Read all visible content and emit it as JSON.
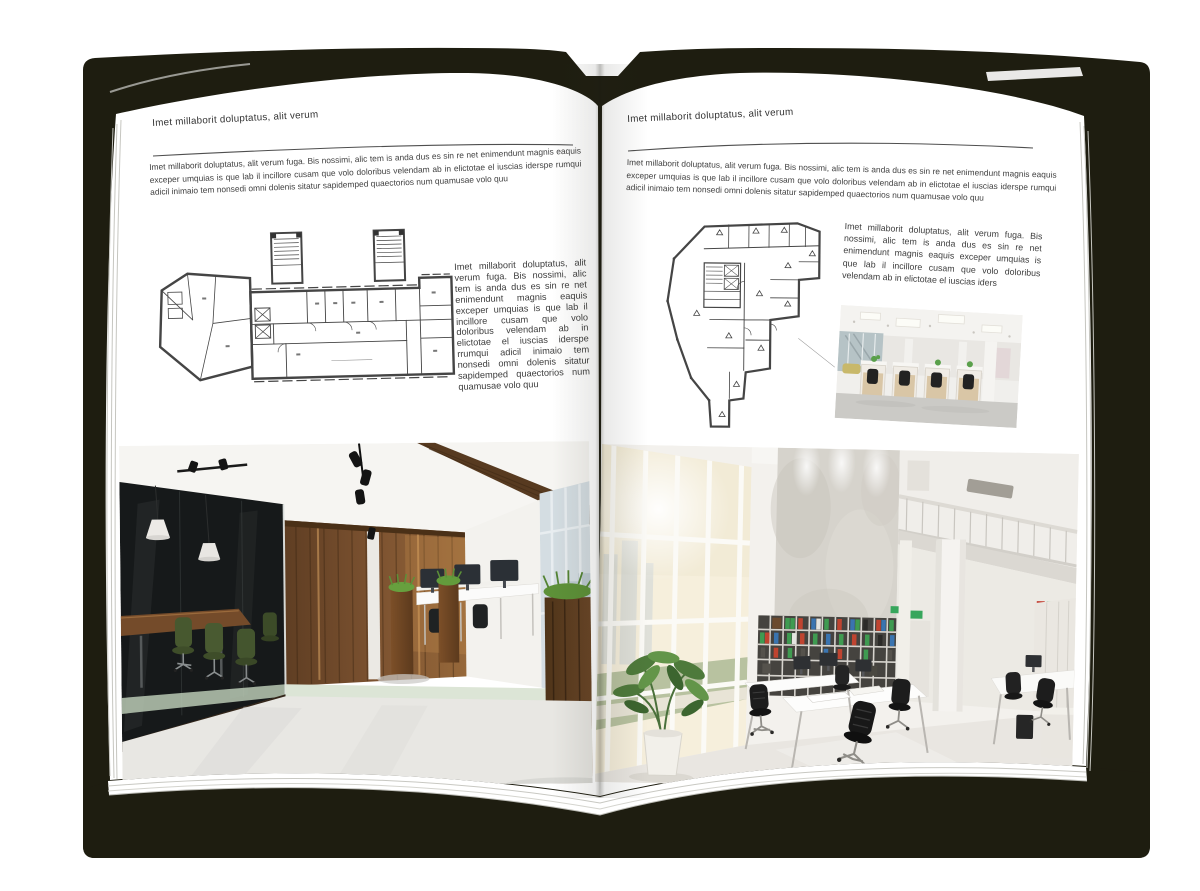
{
  "book": {
    "cover_color": "#1e1d10",
    "page_color": "#ffffff"
  },
  "left_page": {
    "header": "Imet millaborit doluptatus, alit verum",
    "intro": "Imet millaborit doluptatus, alit verum fuga. Bis nossimi, alic tem is anda dus es sin re net enimendunt magnis eaquis exceper umquias is que lab il incillore cusam que volo doloribus velendam ab in elictotae el iuscias iderspe rumqui adicil inimaio tem nonsedi omni dolenis sitatur sapidemped quaectorios num quamusae volo quu",
    "side_text": "Imet millaborit doluptatus, alit verum fuga. Bis nossimi, alic tem is anda dus es sin re net enimendunt magnis eaquis exceper umquias is que lab il incillore cusam que volo doloribus velendam ab in elictotae el iuscias iderspe rrumqui adicil inimaio tem nonsedi omni dolenis sitatur sapidemped quaectorios num quamusae volo quu"
  },
  "right_page": {
    "header": "Imet millaborit doluptatus, alit verum",
    "intro": "Imet millaborit doluptatus, alit verum fuga. Bis nossimi, alic tem is anda dus es sin re net enimendunt magnis eaquis exceper umquias is que lab il incillore cusam que volo doloribus velendam ab in elictotae el iuscias iderspe rumqui adicil inimaio tem nonsedi omni dolenis sitatur sapidemped quaectorios num quamusae volo quu",
    "side_text": "Imet millaborit doluptatus, alit verum fuga. Bis nossimi, alic tem is anda dus es sin re net enimendunt magnis eaquis exceper umquias is que lab il incillore cusam que volo doloribus velendam ab in elictotae el iuscias iders"
  }
}
